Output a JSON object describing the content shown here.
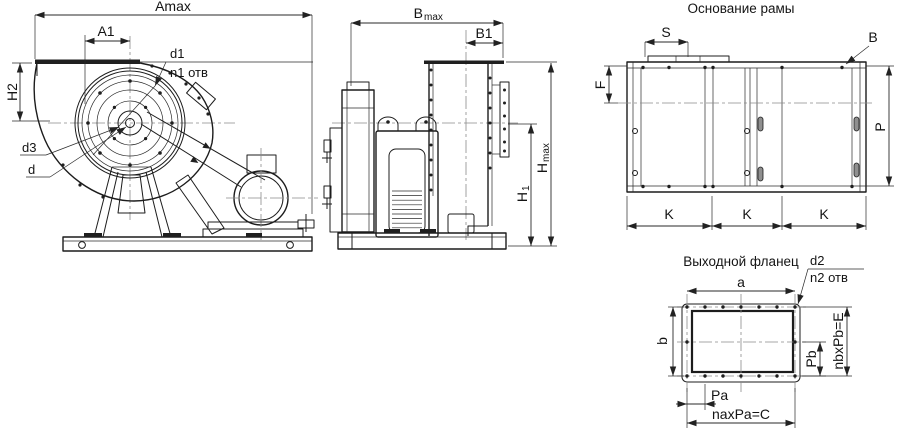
{
  "front_view": {
    "dim_amax": "Amax",
    "dim_a1": "A1",
    "dim_h2": "H2",
    "callout_d1": "d1",
    "callout_n1": "n1 отв",
    "callout_d3": "d3",
    "callout_d": "d"
  },
  "side_view": {
    "dim_bmax_main": "B",
    "dim_bmax_sub": "max",
    "dim_b1": "B1",
    "dim_h1_main": "H",
    "dim_h1_sub": "1",
    "dim_hmax_main": "H",
    "dim_hmax_sub": "max"
  },
  "frame_view": {
    "title": "Основание рамы",
    "dim_s": "S",
    "callout_b": "B",
    "dim_f": "F",
    "dim_p": "P",
    "dim_k": "K"
  },
  "flange_view": {
    "title": "Выходной фланец",
    "dim_a": "a",
    "dim_b": "b",
    "callout_d2": "d2",
    "callout_n2": "n2 отв",
    "dim_pb": "Pb",
    "dim_e": "nbxPb=E",
    "dim_pa": "Pa",
    "dim_c": "naxPa=C"
  },
  "colors": {
    "background": "#ffffff",
    "line": "#1c1c1c",
    "dimension": "#2a2a2a",
    "centerline": "#8b8b8b"
  }
}
